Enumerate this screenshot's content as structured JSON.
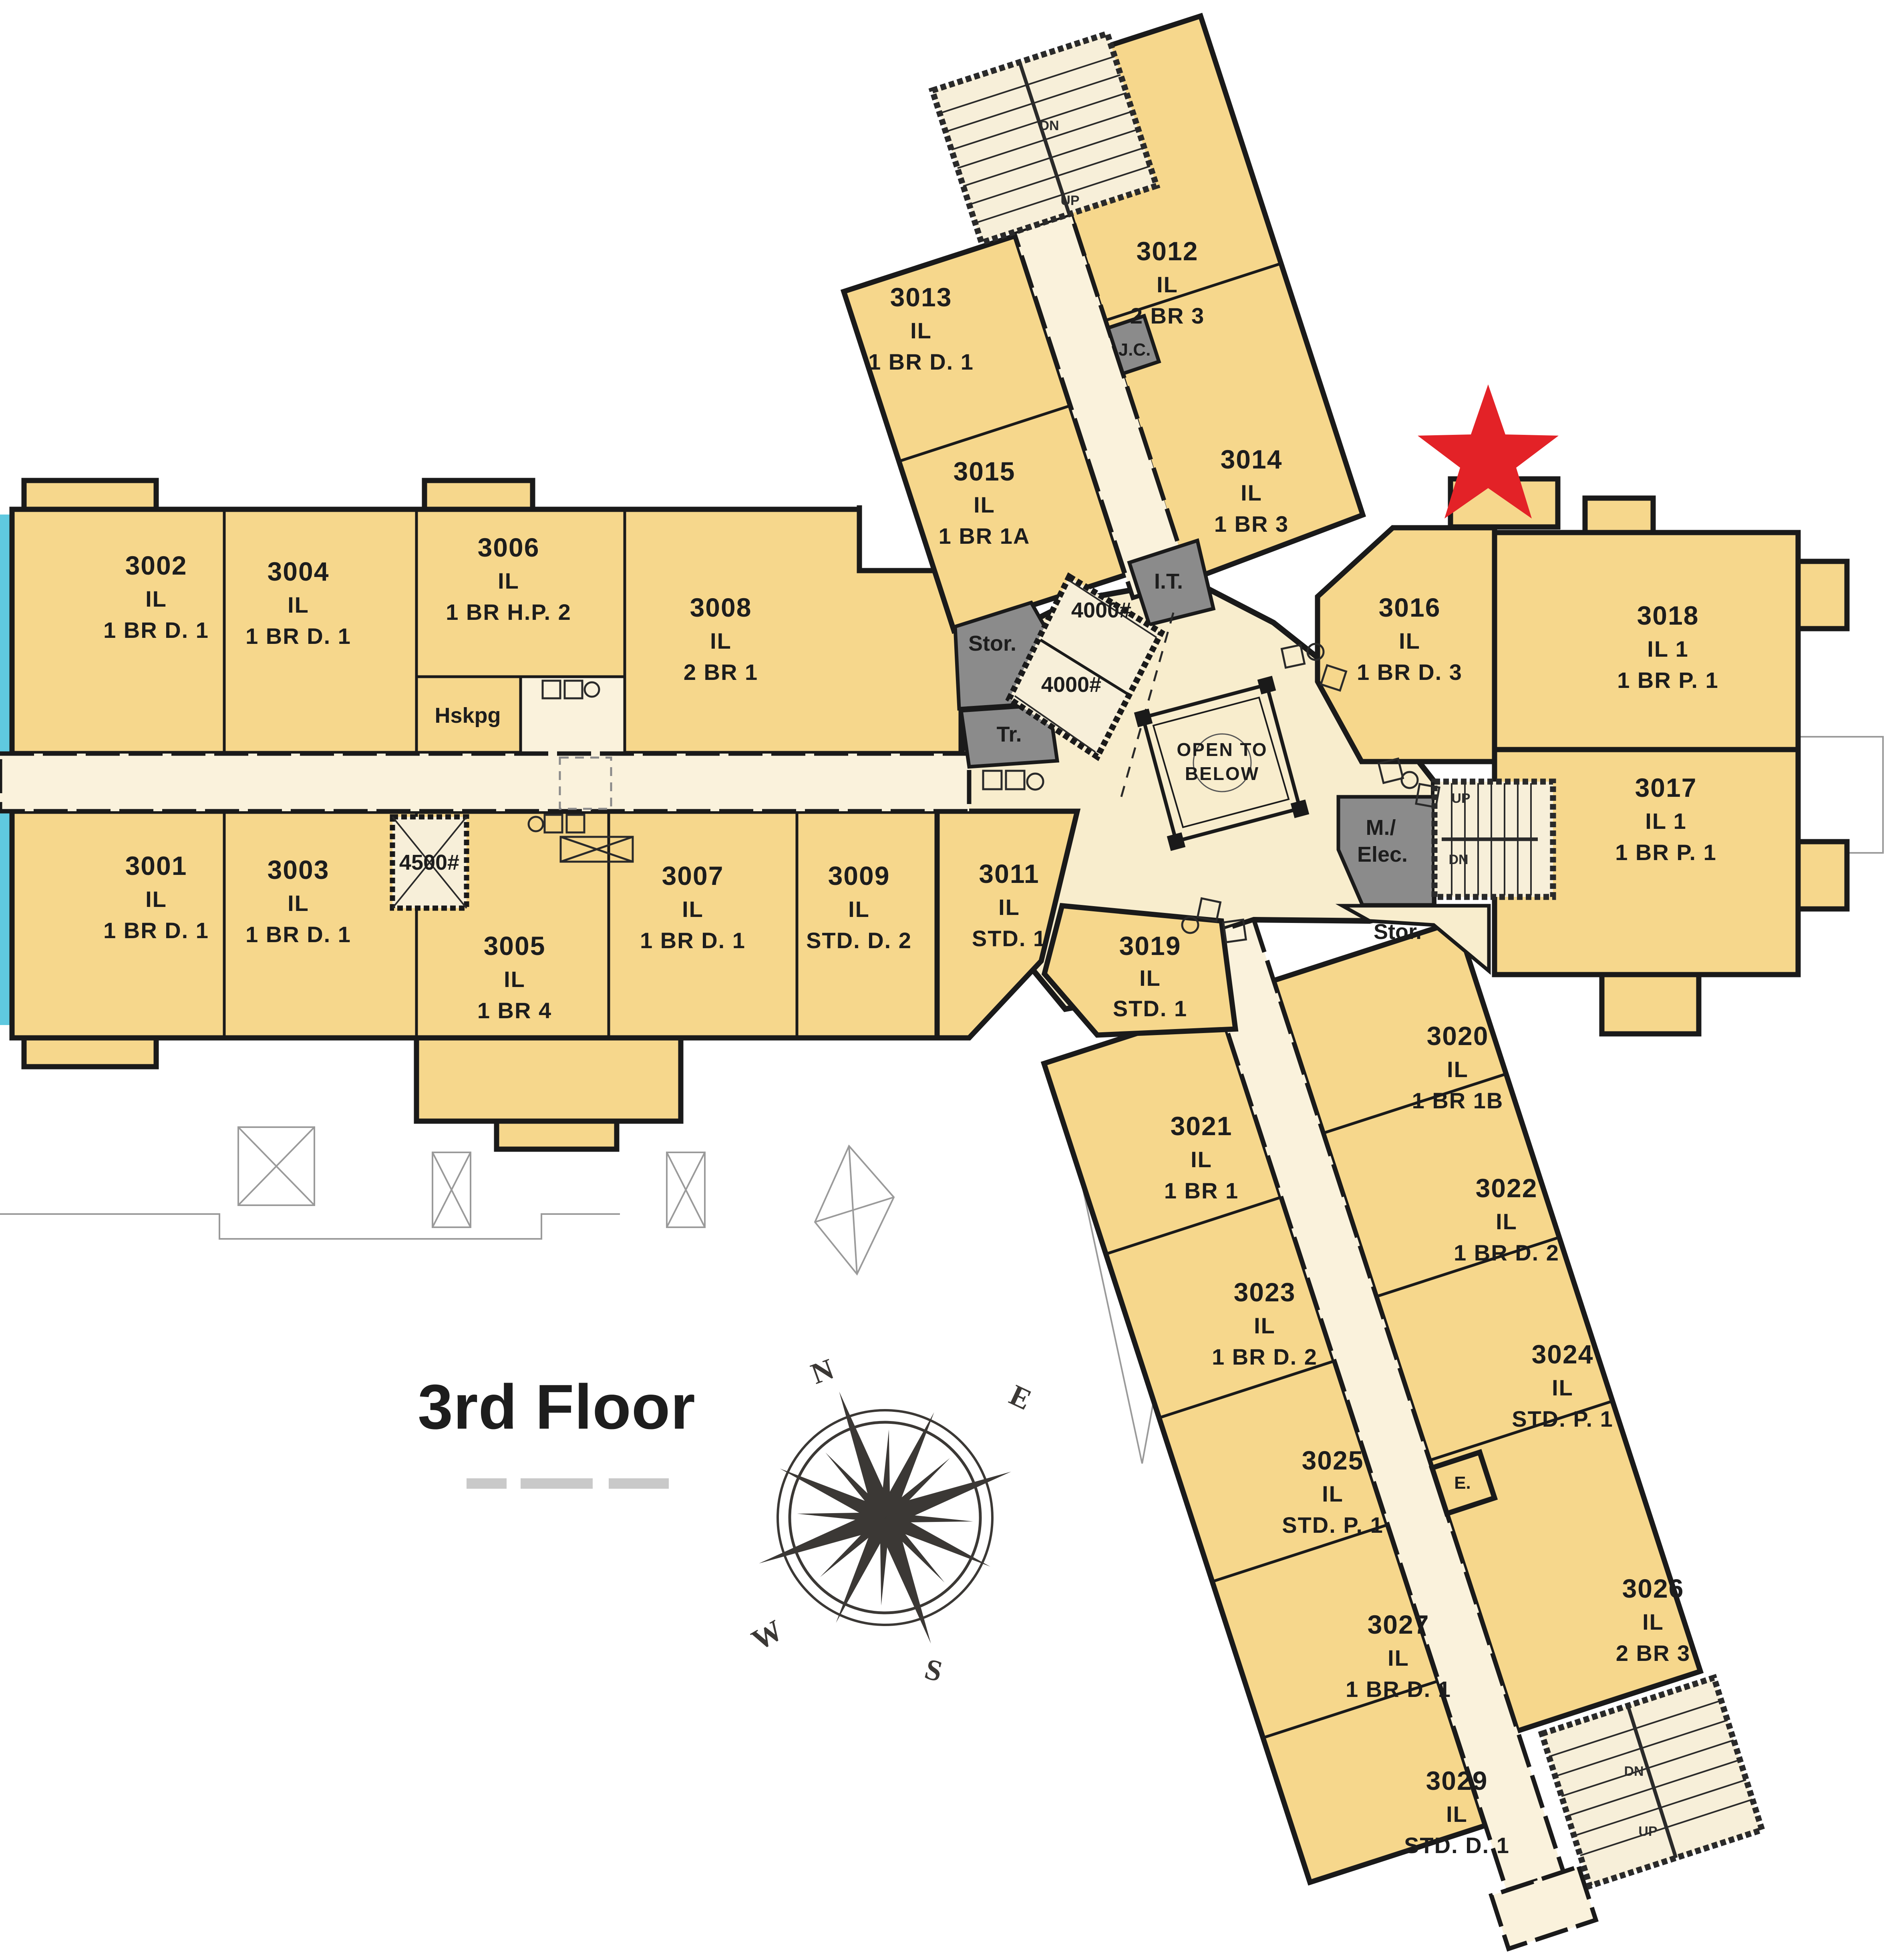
{
  "title_block": {
    "floor_title": "3rd Floor"
  },
  "colors": {
    "room_fill": "#F6D78C",
    "corridor_fill": "#FAF2DC",
    "lobby_fill": "#F8EDCD",
    "service_gray": "#8B8B8B",
    "wall": "#1A1A1A",
    "water_cyan": "#5FC9E0",
    "star_red": "#E32227",
    "compass_dark": "#3B3835"
  },
  "rooms": [
    {
      "number": "3001",
      "line2": "IL",
      "line3": "1 BR D. 1"
    },
    {
      "number": "3002",
      "line2": "IL",
      "line3": "1 BR D. 1"
    },
    {
      "number": "3003",
      "line2": "IL",
      "line3": "1 BR D. 1"
    },
    {
      "number": "3004",
      "line2": "IL",
      "line3": "1 BR D. 1"
    },
    {
      "number": "3005",
      "line2": "IL",
      "line3": "1 BR 4"
    },
    {
      "number": "3006",
      "line2": "IL",
      "line3": "1 BR H.P. 2"
    },
    {
      "number": "3007",
      "line2": "IL",
      "line3": "1 BR D. 1"
    },
    {
      "number": "3008",
      "line2": "IL",
      "line3": "2 BR 1"
    },
    {
      "number": "3009",
      "line2": "IL",
      "line3": "STD. D. 2"
    },
    {
      "number": "3011",
      "line2": "IL",
      "line3": "STD. 1"
    },
    {
      "number": "3012",
      "line2": "IL",
      "line3": "2 BR 3"
    },
    {
      "number": "3013",
      "line2": "IL",
      "line3": "1 BR D. 1"
    },
    {
      "number": "3014",
      "line2": "IL",
      "line3": "1 BR 3"
    },
    {
      "number": "3015",
      "line2": "IL",
      "line3": "1 BR 1A"
    },
    {
      "number": "3016",
      "line2": "IL",
      "line3": "1 BR D. 3"
    },
    {
      "number": "3017",
      "line2": "IL 1",
      "line3": "1 BR P. 1"
    },
    {
      "number": "3018",
      "line2": "IL 1",
      "line3": "1 BR P. 1"
    },
    {
      "number": "3019",
      "line2": "IL",
      "line3": "STD. 1"
    },
    {
      "number": "3020",
      "line2": "IL",
      "line3": "1 BR 1B"
    },
    {
      "number": "3021",
      "line2": "IL",
      "line3": "1 BR 1"
    },
    {
      "number": "3022",
      "line2": "IL",
      "line3": "1 BR D. 2"
    },
    {
      "number": "3023",
      "line2": "IL",
      "line3": "1 BR D. 2"
    },
    {
      "number": "3024",
      "line2": "IL",
      "line3": "STD. P. 1"
    },
    {
      "number": "3025",
      "line2": "IL",
      "line3": "STD. P. 1"
    },
    {
      "number": "3026",
      "line2": "IL",
      "line3": "2 BR 3"
    },
    {
      "number": "3027",
      "line2": "IL",
      "line3": "1 BR D. 1"
    },
    {
      "number": "3029",
      "line2": "IL",
      "line3": "STD. D. 1"
    }
  ],
  "labels": {
    "hskpg": "Hskpg",
    "stor_upper": "Stor.",
    "trash": "Tr.",
    "it": "I.T.",
    "jc": "J.C.",
    "open_below_line1": "OPEN TO",
    "open_below_line2": "BELOW",
    "m_elec_line1": "M./",
    "m_elec_line2": "Elec.",
    "stor_lower": "Stor.",
    "elev_e": "E.",
    "elev_4500": "4500#",
    "elev_4000_upper": "4000#",
    "elev_4000_lower": "4000#"
  },
  "stairs": {
    "top": {
      "dn": "DN",
      "up": "UP"
    },
    "mid": {
      "up": "UP",
      "dn": "DN"
    },
    "bottom": {
      "dn": "DN",
      "up": "UP"
    }
  },
  "compass": {
    "n": "N",
    "e": "E",
    "s": "S",
    "w": "W"
  }
}
